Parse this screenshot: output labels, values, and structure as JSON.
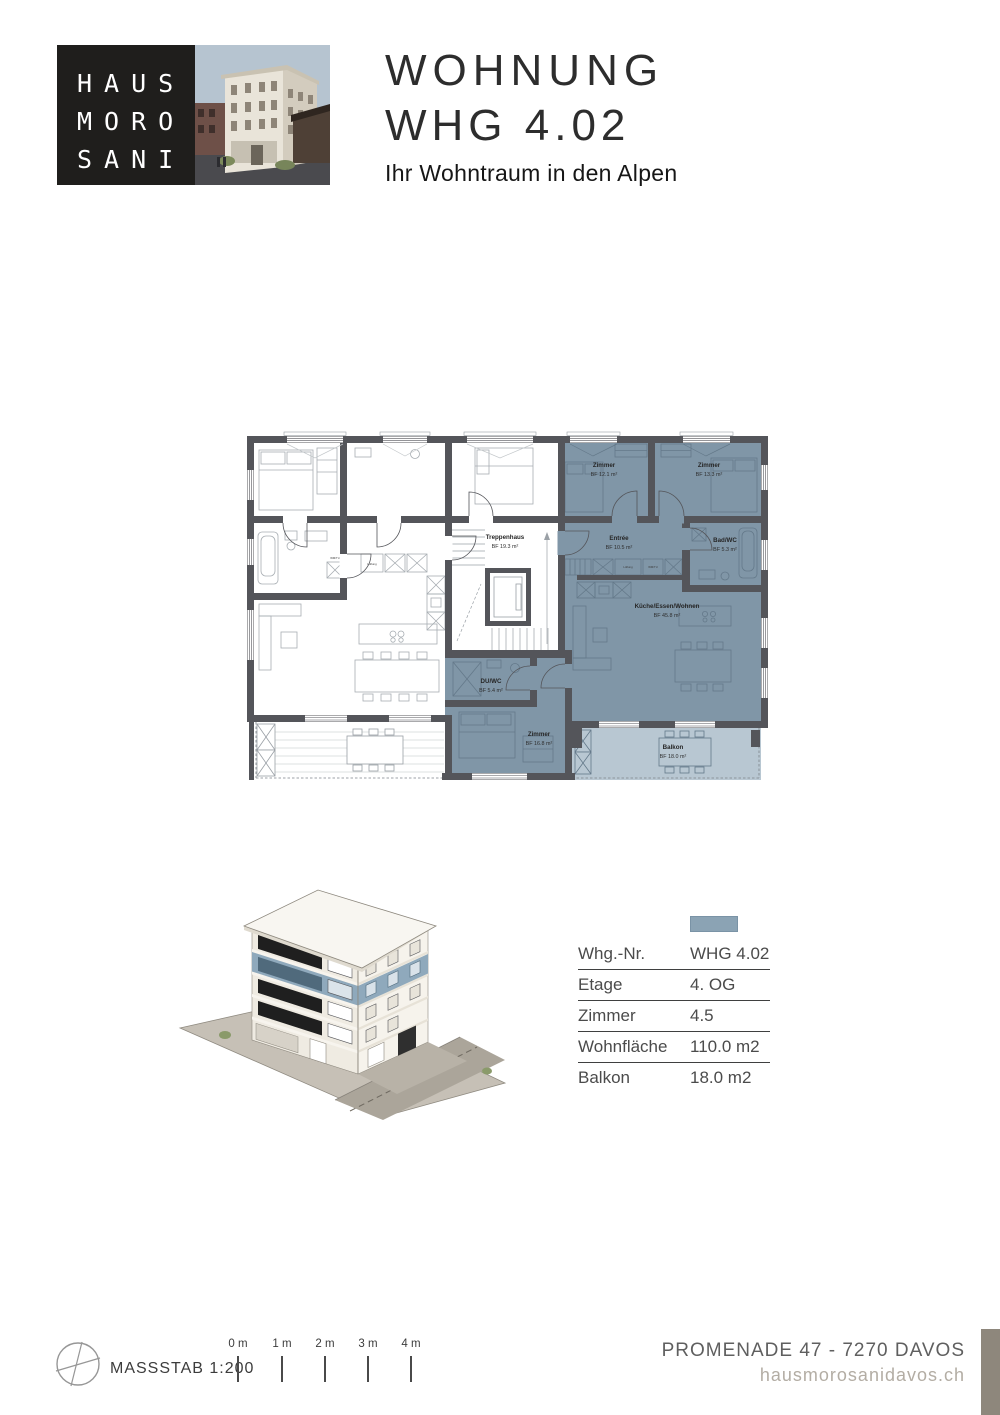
{
  "header": {
    "logo": {
      "line1": "HAUS",
      "line2": "MORO",
      "line3": "SANI"
    },
    "title_line1": "WOHNUNG",
    "title_line2": "WHG 4.02",
    "subtitle": "Ihr Wohntraum in den Alpen"
  },
  "floorplan": {
    "rooms": [
      {
        "name": "Zimmer",
        "area": "BF 12.1 m²"
      },
      {
        "name": "Zimmer",
        "area": "BF 13.3 m²"
      },
      {
        "name": "Entrée",
        "area": "BF 10.5 m²"
      },
      {
        "name": "Bad/WC",
        "area": "BF 5.3 m²"
      },
      {
        "name": "Treppenhaus",
        "area": "BF 19.3 m²"
      },
      {
        "name": "Küche/Essen/Wohnen",
        "area": "BF 45.8 m²"
      },
      {
        "name": "DU/WC",
        "area": "BF 5.4 m²"
      },
      {
        "name": "Zimmer",
        "area": "BF 16.8 m²"
      },
      {
        "name": "Balkon",
        "area": "BF 18.0 m²"
      }
    ],
    "fixture_labels": {
      "lueftung": "Lüftung",
      "wmtu": "WM/TU"
    }
  },
  "info_table": {
    "rows": [
      {
        "label": "Whg.-Nr.",
        "value": "WHG 4.02"
      },
      {
        "label": "Etage",
        "value": "4. OG"
      },
      {
        "label": "Zimmer",
        "value": "4.5"
      },
      {
        "label": "Wohnfläche",
        "value": "110.0 m2"
      },
      {
        "label": "Balkon",
        "value": "18.0 m2"
      }
    ]
  },
  "footer": {
    "scale_label": "MASSSTAB 1:200",
    "scale_ticks": [
      "0 m",
      "1 m",
      "2 m",
      "3 m",
      "4 m"
    ],
    "address": "PROMENADE 47 - 7270 DAVOS",
    "website": "hausmorosanidavos.ch"
  },
  "colors": {
    "highlight_room": "#8096a7",
    "balcony_light": "#b8c7d2",
    "wall": "#54555a",
    "legend_swatch": "#8ba3b4",
    "corner_bar": "#8e877c"
  }
}
